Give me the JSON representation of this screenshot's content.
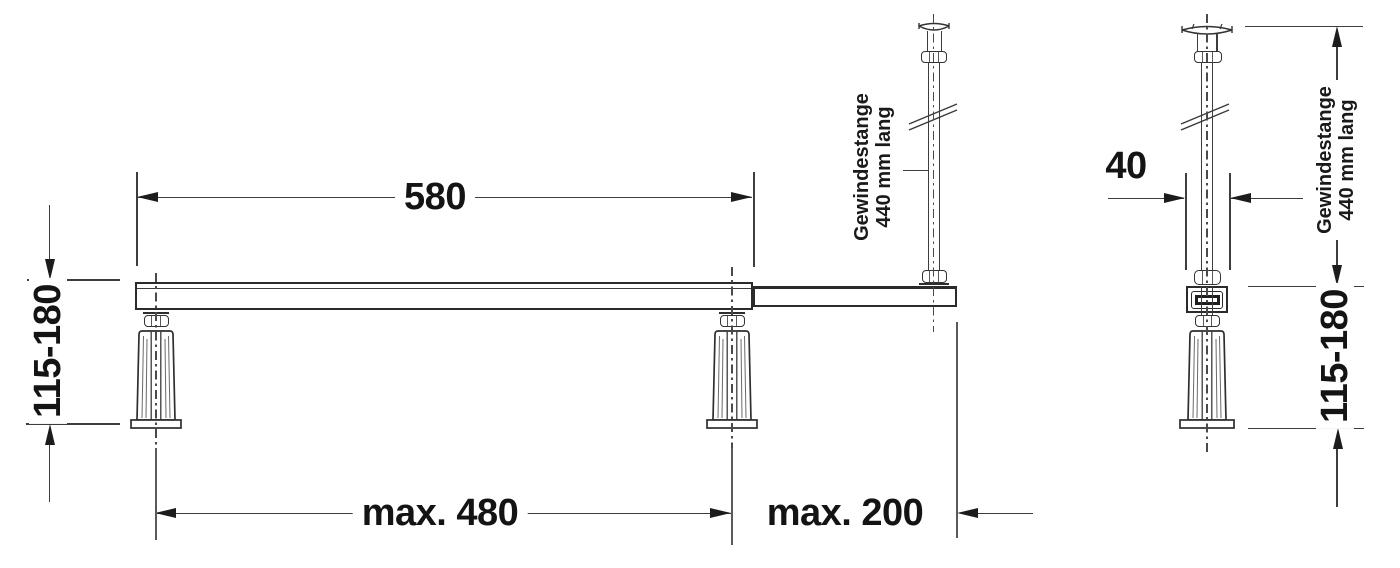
{
  "front_view": {
    "dim_bar_length": "580",
    "dim_height_range": "115-180",
    "dim_foot_span": "max. 480",
    "dim_extension": "max. 200",
    "rod_label": {
      "line1": "Gewindestange",
      "line2": "440 mm lang"
    }
  },
  "side_view": {
    "dim_width": "40",
    "dim_height_range": "115-180",
    "rod_label": {
      "line1": "Gewindestange",
      "line2": "440 mm lang"
    }
  },
  "colors": {
    "line": "#3d3d3d",
    "text": "#141414",
    "background": "#ffffff"
  }
}
